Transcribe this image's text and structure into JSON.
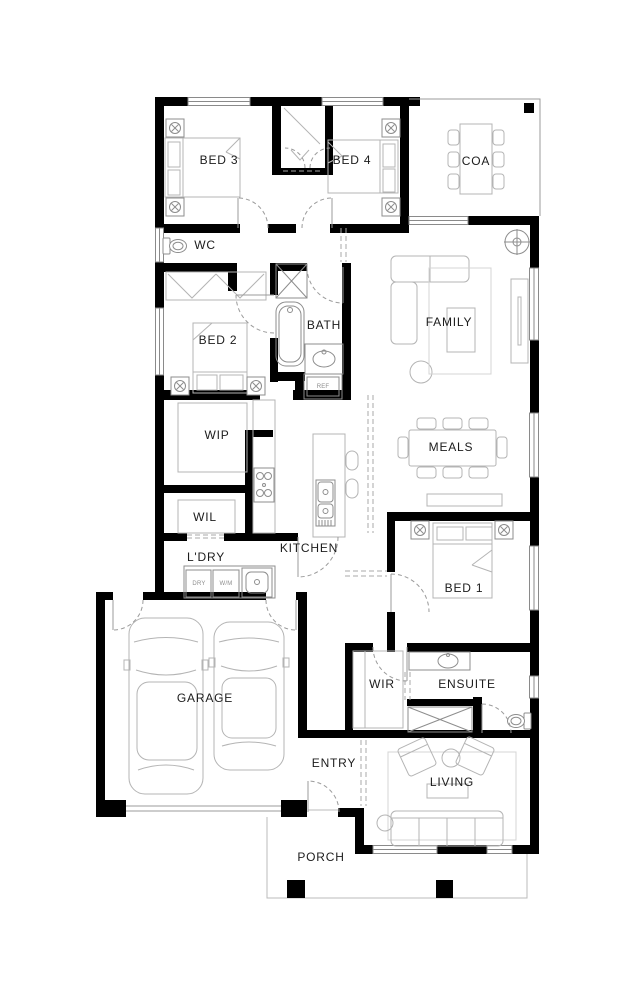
{
  "plan": {
    "type": "single-storey house floor plan",
    "rooms": [
      {
        "id": "bed3",
        "label": "BED 3"
      },
      {
        "id": "bed4",
        "label": "BED 4"
      },
      {
        "id": "coa",
        "label": "COA"
      },
      {
        "id": "wc",
        "label": "WC"
      },
      {
        "id": "bath",
        "label": "BATH"
      },
      {
        "id": "family",
        "label": "FAMILY"
      },
      {
        "id": "bed2",
        "label": "BED 2"
      },
      {
        "id": "wip",
        "label": "WIP"
      },
      {
        "id": "meals",
        "label": "MEALS"
      },
      {
        "id": "wil",
        "label": "WIL"
      },
      {
        "id": "ldry",
        "label": "L'DRY"
      },
      {
        "id": "kitchen",
        "label": "KITCHEN"
      },
      {
        "id": "bed1",
        "label": "BED 1"
      },
      {
        "id": "garage",
        "label": "GARAGE"
      },
      {
        "id": "wir",
        "label": "WIR"
      },
      {
        "id": "ensuite",
        "label": "ENSUITE"
      },
      {
        "id": "entry",
        "label": "ENTRY"
      },
      {
        "id": "living",
        "label": "LIVING"
      },
      {
        "id": "porch",
        "label": "PORCH"
      }
    ],
    "appliances": {
      "fridge": "REF",
      "dryer": "DRY",
      "washer": "W/M"
    },
    "colors": {
      "wall": "#000000",
      "furniture": "#b4b4b4",
      "fixture": "#8d8d8d",
      "dash": "#9b9b9b",
      "label": "#1c1c1c",
      "background": "#ffffff"
    }
  }
}
